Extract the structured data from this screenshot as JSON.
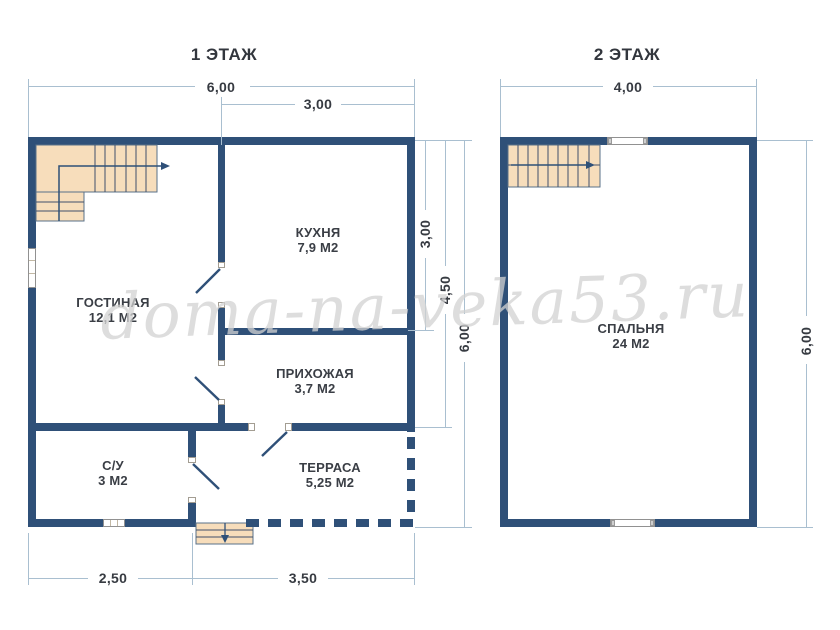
{
  "floor1": {
    "title": "1 ЭТАЖ",
    "rooms": {
      "living": {
        "name": "ГОСТИНАЯ",
        "area": "12,1 М2"
      },
      "kitchen": {
        "name": "КУХНЯ",
        "area": "7,9 М2"
      },
      "hall": {
        "name": "ПРИХОЖАЯ",
        "area": "3,7 М2"
      },
      "bath": {
        "name": "С/У",
        "area": "3 М2"
      },
      "terrace": {
        "name": "ТЕРРАСА",
        "area": "5,25 М2"
      }
    },
    "dims": {
      "width_total": "6,00",
      "width_kitchen": "3,00",
      "height_kitchen": "3,00",
      "height_to_hall": "4,50",
      "height_total": "6,00",
      "bottom_left": "2,50",
      "bottom_right": "3,50"
    }
  },
  "floor2": {
    "title": "2 ЭТАЖ",
    "rooms": {
      "bedroom": {
        "name": "СПАЛЬНЯ",
        "area": "24 М2"
      }
    },
    "dims": {
      "width_total": "4,00",
      "height_total": "6,00"
    }
  },
  "watermark": "doma-na-veka53.ru",
  "colors": {
    "wall": "#2f5078",
    "stair_fill": "#f7ddbb",
    "dimension_line": "#a9bfd0",
    "label_text": "#3a3e45",
    "watermark": "#d2d2d2"
  }
}
